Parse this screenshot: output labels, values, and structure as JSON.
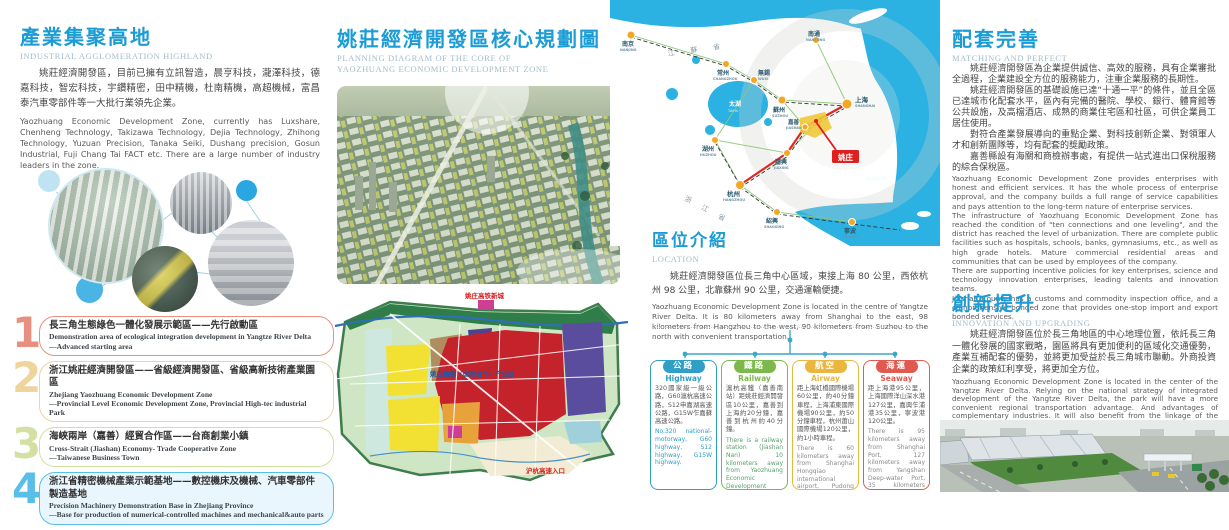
{
  "colors": {
    "accent_blue": "#1c9cd4",
    "subtitle_gray": "#a3bccb",
    "map_water": "#2cb2e2",
    "map_city_dot": "#f5a623",
    "yaozhuang_red": "#e01f1f"
  },
  "panel1": {
    "title": "產業集聚高地",
    "subtitle": "INDUSTRIAL AGGLOMERATION HIGHLAND",
    "para_cn": "姚莊經濟開發區，目前已擁有立訊智造，晨亨科技，瀧澤科技，德嘉科技，智宏科技，宇鑽精密，田中精機，杜南精機，高超機械，富昌泰汽車零部件等一大批行業領先企業。",
    "para_en": "Yaozhuang Economic Development Zone, currently has Luxshare, Chenheng Technology, Takizawa Technology, Dejia Technology, Zhihong Technology, Yuzuan Precision, Tanaka Seiki, Dushang precision, Gosun Industrial, Fuji Chang Tai FACT etc. There are a large number of industry leaders in the zone.",
    "items": [
      {
        "num": "1",
        "color": "#e89080",
        "bg": "#ffffff",
        "cn": "長三角生態綠色一體化發展示範區——先行啟動區",
        "en": "Demonstration area of ecological integration development in Yangtze River Delta",
        "en2": "—Advanced starting area"
      },
      {
        "num": "2",
        "color": "#f0d49e",
        "bg": "#ffffff",
        "cn": "浙江姚莊經濟開發區——省級經濟開發區、省級高新技術產業園區",
        "en": "Zhejiang Yaozhuang Economic Development Zone",
        "en2": "—Provincial Level Economic Development Zone, Provincial High-tec industrial Park"
      },
      {
        "num": "3",
        "color": "#d4e0a2",
        "bg": "#ffffff",
        "cn": "海峽兩岸（嘉善）經貿合作區——台商創業小鎮",
        "en": "Cross-Strait (Jiashan) Economy- Trade Cooperative Zone",
        "en2": "—Taiwanese Business Town"
      },
      {
        "num": "4",
        "color": "#59bfe8",
        "bg": "#e9f6fd",
        "cn": "浙江省精密機械產業示範基地——數控機床及機械、汽車零部件製造基地",
        "en": "Precision Machinery Demonstration Base in Zhejiang Province",
        "en2": "—Base for production of numerical-controlled machines and mechanical&auto  parts"
      }
    ]
  },
  "panel2": {
    "title": "姚莊經濟開發區核心規劃圖",
    "subtitle1": "PLANNING DIAGRAM OF THE CORE OF",
    "subtitle2": "YAOZHUANG ECONOMIC DEVELOPMENT ZONE",
    "zone_map": {
      "top_label": "姚庄高铁新城",
      "center_label": "姚庄精密（国际合作）产业区",
      "entrance_label": "沪杭高速入口"
    }
  },
  "panel3": {
    "location_title": "區位介紹",
    "location_subtitle": "LOCATION",
    "para_cn": "姚莊經濟開發區位長三角中心區域，東接上海 80 公里，西依杭州 98 公里，北靠蘇州 90 公里，交通運輸便捷。",
    "para_en": "Yaozhuang Economic Development Zone is located in the centre of Yangtze River Delta. It is 80 kilometers away from Shanghai to the east, 98 kilometers from Hangzhou to the west, 90 kilometers from Suzhou to the north with convenient transportation.",
    "transport": [
      {
        "cn_label": "公路",
        "en_label": "Highway",
        "color": "#2f9fc6",
        "en_color": "#2f9fc6",
        "cn": "320國家級一級公路，G60滬杭高速公路，S12申嘉湖高速公路，G15W乍嘉蘇高速公路。",
        "en": "No.320 national-motorway, G60 highway, S12 highway, G15W highway."
      },
      {
        "cn_label": "鐵路",
        "en_label": "Railway",
        "color": "#7db84d",
        "en_color": "#57a06b",
        "cn": "滬杭高鐵（嘉善南站）距姚莊經濟開發區10公里，嘉善到上海約20分鐘，嘉善到杭州約40分鐘。",
        "en": "There is a railway station (Jiashan Nan) 10 kilometers away from Yaozhuang Economic Development Zone. It takes about 20 minutes from Jiashan to Shanghai, 40 minutes to Hangzhou."
      },
      {
        "cn_label": "航空",
        "en_label": "Airway",
        "color": "#eab63e",
        "en_color": "#8a8a8a",
        "cn": "距上海虹橋國際機場60公里，約40分鐘車程，上海浦東國際機場90公里，約50分鐘車程，杭州蕭山國際機場120公里，約1小時車程。",
        "en": "There is 60 kilometers away from Shanghai Hongqiao international airport, Pudong international airport 90 kilometers, the Xiaoshan international airport 120 kilometers."
      },
      {
        "cn_label": "海運",
        "en_label": "Seaway",
        "color": "#e05a50",
        "en_color": "#8a8a8a",
        "cn": "距上海港95公里，上海國際洋山深水港127公里，嘉興乍浦港35公里，寧波港120公里。",
        "en": "There is 95 kilometers away from Shanghai Port, 127 kilometers away from Yangshan Deep-water Port, 35 kilometers away from Zhapu Port, 120 kilometers away from Nitong Port."
      }
    ],
    "map": {
      "yaozhuang_label": "姚庄",
      "lake_label": "太湖",
      "lake_en": "TAIHU",
      "province1": "江蘇省",
      "province2": "浙江省",
      "port_label": "洋山深水港",
      "cities": [
        {
          "name": "南京",
          "en": "NANJING"
        },
        {
          "name": "常州",
          "en": "CHANGZHOU"
        },
        {
          "name": "無錫",
          "en": "WUXI"
        },
        {
          "name": "南通",
          "en": "NANTONG"
        },
        {
          "name": "蘇州",
          "en": "SUZHOU"
        },
        {
          "name": "上海",
          "en": "SHANGHAI"
        },
        {
          "name": "湖州",
          "en": "HUZHOU"
        },
        {
          "name": "嘉善",
          "en": "JIASHAN"
        },
        {
          "name": "嘉興",
          "en": "JIAXING"
        },
        {
          "name": "杭州",
          "en": "HANGZHOU"
        },
        {
          "name": "紹興",
          "en": "SHAOXING"
        },
        {
          "name": "寧波",
          "en": "NINGBO"
        }
      ]
    }
  },
  "panel4": {
    "title1": "配套完善",
    "subtitle1": "MATCHING AND PERFECT",
    "cn_paras": [
      "姚莊經濟開發區為企業提供誠信、高效的服務，具有企業審批全過程，企業建設全方位的服務能力，注重企業服務的長期性。",
      "姚莊經濟開發區的基礎設施已達“十通一平”的條件，並且全區已達城市化配套水平，區內有完備的醫院、學校、銀行、體育館等公共設施，及高檔酒店、成熟的商業住宅區和社區，可供企業員工居住使用。",
      "對符合產業發展導向的重點企業、對科技創新企業、對領軍人才和創新團隊等，均有配套的獎勵政策。",
      "嘉善縣設有海關和商檢辦事處，有提供一站式進出口保稅服務的綜合保稅區。"
    ],
    "en_paras": [
      "Yaozhuang Economic Development Zone provides enterprises with honest and efficient services. It has the whole process of enterprise approval, and the company builds a full range of service capabilities and pays attention to the long-term nature of enterprise services.",
      "The infrastructure of Yaozhuang Economic Development Zone has reached the condition of \"ten connections and one leveling\", and the district has reached the level of urbanization. There are complete public facilities such as hospitals, schools, banks, gymnasiums, etc., as well as high grade hotels. Mature commercial residential areas and communities that can be used by employees of the company.",
      "There are supporting incentive policies for key enterprises, science and technology innovation enterprises, leading talents and innovation teams.",
      "Jiashan County has a customs and commodity inspection office, and a comprehensive bonded zone that provides one-stop import and export bonded services."
    ],
    "title2": "創新提升",
    "subtitle2": "INNOVATION AND UPGRADING",
    "cn2": "姚莊經濟開發區位於長三角地區的中心地理位置，依託長三角一體化發展的國家戰略，園區將具有更加便利的區域化交通優勢，產業互補配套的優勢，並將更加受益於長三角城市聯動。外商投資企業的政策紅利享受，將更加全方位。",
    "en2": "Yaozhuang Economic Development Zone is located in the center of the Yangtze River Delta. Relying on the national strategy of integrated development of the Yangtze River Delta, the park will have a more convenient regional transportation advantage. And advantages of complementary industries. It will also benefit from the linkage of the Yangtze River Delta cities and the policy dividends of foreign-invested enterprises are more comprehensive."
  }
}
